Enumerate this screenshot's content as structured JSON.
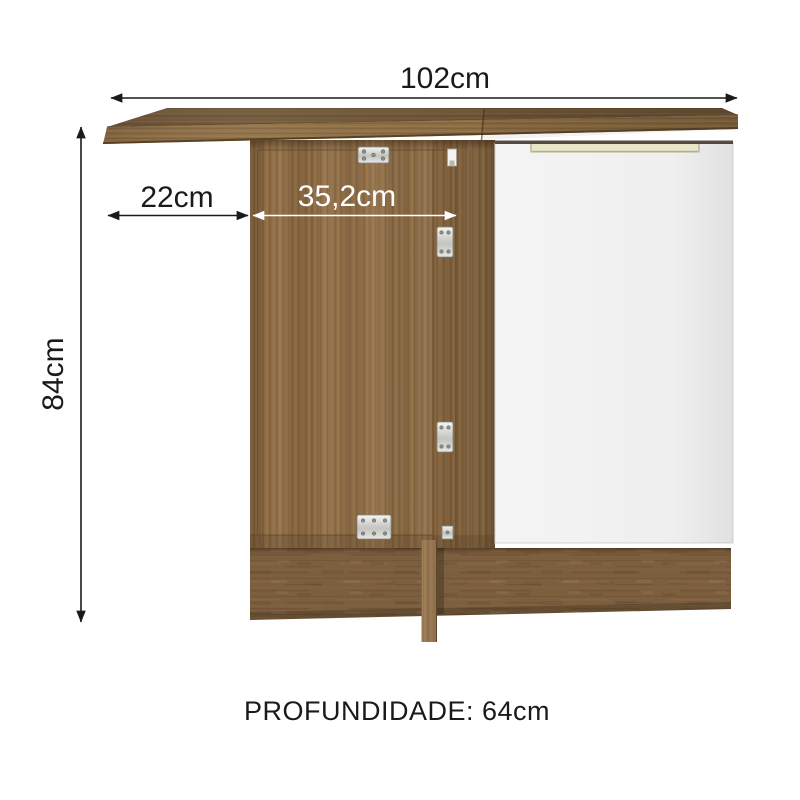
{
  "page": {
    "background": "#ffffff",
    "description_visible_text_only": true
  },
  "annotations": {
    "width": "102cm",
    "left_overhang": "22cm",
    "door_width": "35,2cm",
    "height": "84cm",
    "depth": "PROFUNDIDADE: 64cm"
  },
  "colors": {
    "annotation_text": "#1a1a1a",
    "annotation_arrow": "#1a1a1a",
    "door_width_text": "#ffffff",
    "wood_base": "#8d6b44",
    "countertop_top": "#705739",
    "countertop_edge": "#8f6f46",
    "plinth_wood": "#7c5f3e",
    "white_door": "#f4f4f5",
    "handle": "#e9e5c8",
    "hinge_metal": "#cccccc"
  }
}
